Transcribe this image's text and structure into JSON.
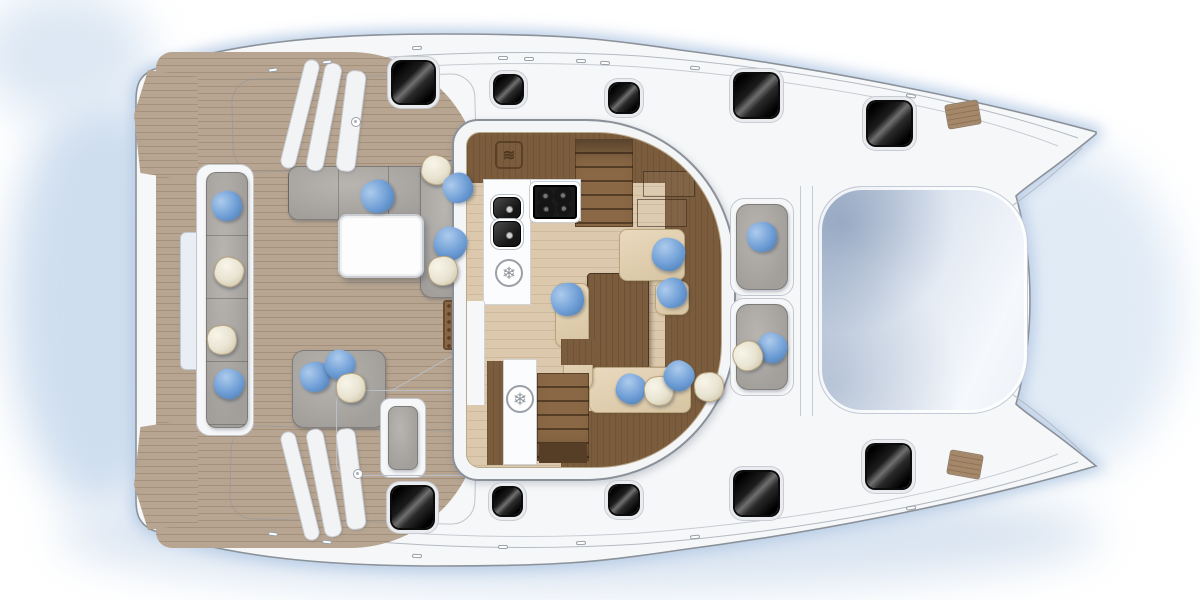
{
  "scene": {
    "kind": "catamaran-yacht-floor-plan",
    "view": "top-down deck and saloon layout, bows to the right, stern to the left"
  },
  "colors": {
    "hull_fill": "#f6f7f8",
    "hull_line": "#8b9199",
    "glow": "#c7d7ea",
    "teak": "#b7a591",
    "teak_line": "#a3917c",
    "floor": "#dcc9ad",
    "floor_line": "#cdb99b",
    "wood": "#7b5c3d",
    "wood_mid": "#8a6845",
    "wood_dark": "#563e26",
    "cushion": "#a29f9b",
    "cushion_hi": "#b8b5b1",
    "cream": "#e8e3d1",
    "cream_dark": "#ccc3a6",
    "blue": "#6f9ed6",
    "blue_dark": "#4c7cb5",
    "tramp_a": "#b6c4d8",
    "tramp_b": "#f5f8fc",
    "mat": "#8a6847"
  },
  "icons": {
    "freezer_glyph": "❄",
    "oven_glyph": "≋"
  },
  "zones": {
    "aft_deck": "teak aft deck with transom steps",
    "aft_cockpit": "aft cockpit with L-sofa, bench, table and helm seat",
    "saloon": "saloon with galley, chart desk, dining table and companionway stairs",
    "foredeck": "forward cockpit seats and trampoline",
    "hulls": "port and starboard hulls with deck hatches"
  },
  "deck": {
    "hatches": [
      {
        "x": 393,
        "y": 62,
        "s": 41
      },
      {
        "x": 495,
        "y": 76,
        "s": 27
      },
      {
        "x": 610,
        "y": 84,
        "s": 28
      },
      {
        "x": 735,
        "y": 74,
        "s": 43
      },
      {
        "x": 868,
        "y": 102,
        "s": 43
      },
      {
        "x": 392,
        "y": 487,
        "s": 41
      },
      {
        "x": 494,
        "y": 488,
        "s": 27
      },
      {
        "x": 610,
        "y": 486,
        "s": 28
      },
      {
        "x": 735,
        "y": 472,
        "s": 43
      },
      {
        "x": 867,
        "y": 445,
        "s": 43
      }
    ],
    "bow_pads": [
      {
        "x": 946,
        "y": 102,
        "r": -10
      },
      {
        "x": 948,
        "y": 452,
        "r": 10
      }
    ],
    "fittings_ticks": [
      {
        "x": 268,
        "y": 68,
        "r": -8
      },
      {
        "x": 322,
        "y": 60,
        "r": -6
      },
      {
        "x": 412,
        "y": 46,
        "r": -2
      },
      {
        "x": 498,
        "y": 56,
        "r": 0
      },
      {
        "x": 524,
        "y": 57,
        "r": 0
      },
      {
        "x": 576,
        "y": 59,
        "r": 2
      },
      {
        "x": 600,
        "y": 61,
        "r": 2
      },
      {
        "x": 690,
        "y": 66,
        "r": 5
      },
      {
        "x": 906,
        "y": 94,
        "r": 9
      },
      {
        "x": 268,
        "y": 532,
        "r": 8
      },
      {
        "x": 322,
        "y": 540,
        "r": 6
      },
      {
        "x": 412,
        "y": 554,
        "r": 2
      },
      {
        "x": 498,
        "y": 545,
        "r": 0
      },
      {
        "x": 576,
        "y": 541,
        "r": -2
      },
      {
        "x": 690,
        "y": 535,
        "r": -5
      },
      {
        "x": 906,
        "y": 506,
        "r": -9
      }
    ],
    "fittings_circles": [
      {
        "x": 351,
        "y": 117
      },
      {
        "x": 353,
        "y": 469
      }
    ],
    "davits": [
      {
        "x": 292,
        "y": 58,
        "w": 16,
        "h": 112,
        "r": 14
      },
      {
        "x": 315,
        "y": 62,
        "w": 18,
        "h": 110,
        "r": 11
      },
      {
        "x": 341,
        "y": 70,
        "w": 20,
        "h": 102,
        "r": 7
      },
      {
        "x": 292,
        "y": 430,
        "w": 16,
        "h": 112,
        "r": -14
      },
      {
        "x": 315,
        "y": 428,
        "w": 18,
        "h": 110,
        "r": -11
      },
      {
        "x": 341,
        "y": 428,
        "w": 20,
        "h": 102,
        "r": -7
      }
    ]
  },
  "soft": {
    "pillows": [
      {
        "x": 227,
        "y": 206,
        "c": "blue",
        "r": -14
      },
      {
        "x": 229,
        "y": 272,
        "c": "cream",
        "r": 16
      },
      {
        "x": 222,
        "y": 340,
        "c": "cream",
        "r": -10
      },
      {
        "x": 229,
        "y": 384,
        "c": "blue",
        "r": 14
      },
      {
        "x": 377,
        "y": 196,
        "c": "blue",
        "r": -24,
        "s": 33
      },
      {
        "x": 436,
        "y": 170,
        "c": "cream",
        "r": 12
      },
      {
        "x": 458,
        "y": 188,
        "c": "blue",
        "r": -30
      },
      {
        "x": 450,
        "y": 243,
        "c": "blue",
        "r": 18,
        "s": 33
      },
      {
        "x": 443,
        "y": 271,
        "c": "cream",
        "r": -12
      },
      {
        "x": 315,
        "y": 377,
        "c": "blue",
        "r": -18
      },
      {
        "x": 340,
        "y": 365,
        "c": "blue",
        "r": 22
      },
      {
        "x": 351,
        "y": 388,
        "c": "cream",
        "r": -8
      },
      {
        "x": 567,
        "y": 299,
        "c": "blue",
        "r": -16,
        "s": 33
      },
      {
        "x": 668,
        "y": 254,
        "c": "blue",
        "r": 10,
        "s": 33
      },
      {
        "x": 672,
        "y": 293,
        "c": "blue",
        "r": -26
      },
      {
        "x": 631,
        "y": 389,
        "c": "blue",
        "r": 18
      },
      {
        "x": 659,
        "y": 391,
        "c": "cream",
        "r": -10
      },
      {
        "x": 679,
        "y": 376,
        "c": "blue",
        "r": 30
      },
      {
        "x": 709,
        "y": 387,
        "c": "cream",
        "r": -6
      },
      {
        "x": 762,
        "y": 237,
        "c": "blue",
        "r": -12
      },
      {
        "x": 772,
        "y": 348,
        "c": "blue",
        "r": 18
      },
      {
        "x": 748,
        "y": 356,
        "c": "cream",
        "r": -30
      }
    ]
  }
}
